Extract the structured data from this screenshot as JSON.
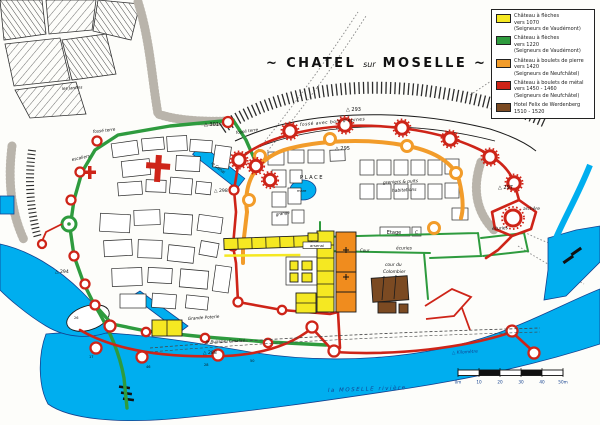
{
  "title": {
    "left": "~ CHATEL",
    "middle": "sur",
    "right": "MOSELLE ~"
  },
  "legend": {
    "entries": [
      {
        "color": "#F5E822",
        "lines": [
          "Château à flèches",
          "vers 1070",
          "(Seigneurs de Vaudémont)"
        ]
      },
      {
        "color": "#2E9B3E",
        "lines": [
          "Château à flèches",
          "vers 1220",
          "(Seigneurs de Vaudémont)"
        ]
      },
      {
        "color": "#F29C2A",
        "lines": [
          "Château à boulets de pierre",
          "vers 1420",
          "(Seigneurs de Neufchâtel)"
        ]
      },
      {
        "color": "#CE2418",
        "lines": [
          "Château à boulets de métal",
          "vers 1450 - 1460",
          "(Seigneurs de Neufchâtel)"
        ]
      },
      {
        "color": "#7B4A22",
        "lines": [
          "Hotel Felix de Werdenberg",
          "1510 - 1520"
        ]
      }
    ]
  },
  "labels": {
    "jardins": "les Jardins",
    "fosse_terre_w": "fossé terre",
    "fosse_terre_n": "fossé terre",
    "escaliers": "escaliers",
    "fosse_epines": "fossé avec bois d'épines",
    "place": "PLACE",
    "greniers_1": "greniers & puits",
    "greniers_2": "habitations",
    "mare": "mare",
    "grange": "grange",
    "arsenal": "arsenal",
    "etage": "Etage",
    "etage_c": "C",
    "ecuries_s": "écuries",
    "ecuries_e": "écuries",
    "cour": "Cour",
    "colombier_1": "cour du",
    "colombier_2": "Colombier",
    "archere": "archère",
    "canal": "le Canal",
    "grande_poterie": "Grande Poterie",
    "ruisseau": "le Ruisseau Canalisé",
    "moselle": "la MOSELLE rivière",
    "kilometre": "△ Kilomètre"
  },
  "elevations": {
    "north": "△ 293",
    "inner": "△ 295",
    "northwest": "△ 301",
    "east": "△ 297",
    "west": "△ 294",
    "canal": "△ 298",
    "south": "△ 288"
  },
  "tower_numbers": [
    "17",
    "46",
    "28",
    "50",
    "26"
  ],
  "scale_bar": {
    "labels": [
      "0m",
      "10",
      "20",
      "30",
      "40",
      "50m"
    ]
  },
  "colors": {
    "water": "#00AEEF",
    "phase_1070_yellow": "#F5E822",
    "phase_1220_green": "#2E9B3E",
    "phase_1420_orange": "#F29C2A",
    "phase_1450_red": "#CE2418",
    "phase_1510_brown": "#7B4A22",
    "ink": "#1B1B1B",
    "river_text": "#14418F"
  }
}
